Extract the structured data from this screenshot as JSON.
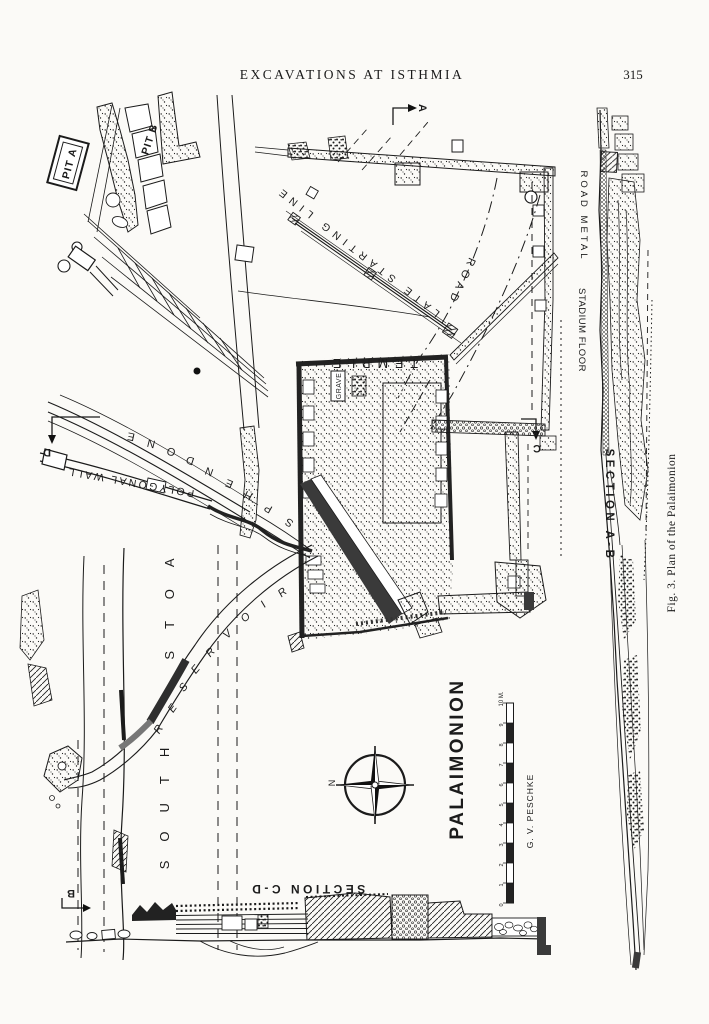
{
  "page": {
    "header": "EXCAVATIONS AT ISTHMIA",
    "page_number": "315"
  },
  "figure": {
    "caption": "Fig. 3. Plan of the Palaimonion",
    "credit": "G. V. PESCHKE",
    "compass_north": "N",
    "section_markers": {
      "a": "A",
      "b": "B",
      "c": "C",
      "d": "D"
    },
    "plan_labels": {
      "pit_a": "PIT A",
      "pit_b": "PIT B",
      "late_starting_line": "LATE STARTING LINE",
      "road": "ROAD",
      "temple": "TEMPLE",
      "grave": "GRAVE",
      "polygonal_wall": "POLYGONAL WALL",
      "sphendone": {
        "label": "SPHENDONE",
        "letters": [
          "S",
          "P",
          "H",
          "E",
          "N",
          "D",
          "O",
          "N",
          "E"
        ]
      },
      "south_stoa": {
        "label": "SOUTH STOA",
        "word1": "SOUTH",
        "word2": "STOA"
      },
      "reservoir": {
        "label": "RESERVOIR",
        "letters": [
          "R",
          "E",
          "S",
          "E",
          "R",
          "V",
          "O",
          "I",
          "R"
        ]
      },
      "palaimonion": "PALAIMONION",
      "section_cd": "SECTION C-D"
    },
    "section_ab": {
      "title": "SECTION A-B",
      "road_metal": "ROAD METAL",
      "stadium_floor": "STADIUM FLOOR"
    },
    "scale": {
      "ticks": [
        "0",
        "1",
        "2",
        "3",
        "4",
        "5",
        "6",
        "7",
        "8",
        "9"
      ],
      "end": "10 M."
    },
    "ink_color": "#1b1b1b",
    "paper_color": "#fbfaf7"
  }
}
